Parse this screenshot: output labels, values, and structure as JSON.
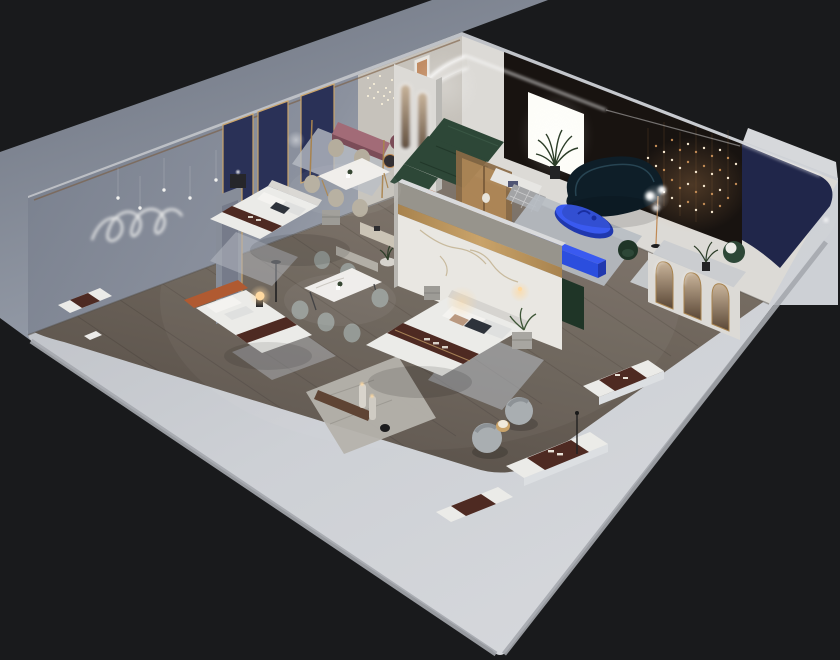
{
  "meta": {
    "label": "Isometric 3D cutaway render of a furnished apartment showroom with bedrooms, dining sets, lounge and living area"
  },
  "palette": {
    "bg": "#191a1c",
    "backdropLight": "#9ba2ae",
    "backdropDark": "#6e7481",
    "slabTop": "#cdd0d5",
    "slabTopDark": "#b4b7bd",
    "slabSide": "#a6a9af",
    "wallTop": "#d6d8db",
    "wallFace": "#8b919e",
    "wallFaceDark": "#767d8b",
    "wallWarm": "#c6c2bb",
    "wallWhite": "#dcdad6",
    "woodLight": "#7d7368",
    "woodDark": "#564e47",
    "marble": "#e9e7e2",
    "marbleVein": "#c2b291",
    "marbleGray": "#97948c",
    "gold": "#a8834e",
    "goldBright": "#c9a36a",
    "navy": "#2a3157",
    "navyCanopy": "#20264a",
    "darkWall": "#181310",
    "lightPanel": "#fdfdf8",
    "greenSofa": "#2d4737",
    "greenDark": "#1f3527",
    "teal": "#0e1e28",
    "tealEdge": "#2e4d5c",
    "cobalt": "#2b4ede",
    "cobaltLight": "#3a5af0",
    "cobaltDark": "#2038ae",
    "rose": "#a26b77",
    "mauve": "#7b4c58",
    "rust": "#b05a31",
    "brandBrown": "#4e2a22",
    "bedWhite": "#ebebe8",
    "pillowShade": "#dfe0df",
    "pillowDark": "#2e333b",
    "rugLight": "#b7bcc3",
    "rugPale": "#c9ccd0",
    "teddy": "#a9aeb1",
    "teddyShade": "#8d9296",
    "copper": "#c08a55",
    "copperWire": "#8a6038",
    "warmGlow": "#ffd9a0",
    "plant": "#3e5637",
    "plantDark": "#2c3d28",
    "silver": "#dcdfe2",
    "charcoal": "#26262a",
    "benchWood": "#5f4434",
    "marbleStrip": "#b5b2ac",
    "creamChair": "#b5ad9d",
    "grayChair": "#959a96",
    "white": "#ffffff"
  },
  "scene": {
    "type": "isometric-cutaway-interior",
    "areas": [
      {
        "name": "left-wall",
        "features": [
          "neon-squiggle-light",
          "hanging-pendant-dots",
          "navy-gold-panels",
          "framed-art"
        ]
      },
      {
        "name": "right-wall",
        "features": [
          "led-arch-corner",
          "backlit-light-panel",
          "dark-feature-wall",
          "copper-fairy-lights",
          "navy-curved-canopy"
        ]
      },
      {
        "name": "living-room",
        "objects": [
          "green-sectional-sofa",
          "wood-glass-partition",
          "teal-curved-sofa",
          "cobalt-oval-table",
          "cobalt-tv-console",
          "globe-floor-lamp",
          "green-accent-chair",
          "palm-plant",
          "checkered-ottoman",
          "white-credenza"
        ]
      },
      {
        "name": "lounge",
        "objects": [
          "rose-bench",
          "mauve-poufs",
          "round-tray-table",
          "rust-armchairs",
          "cluster-pendant",
          "pill-arch-partition"
        ]
      },
      {
        "name": "dining",
        "objects": [
          "dining-table-a",
          "cream-chairs",
          "dining-table-b",
          "gray-chairs",
          "black-floor-lamp",
          "brass-poles"
        ]
      },
      {
        "name": "bedrooms",
        "objects": [
          "bed-a",
          "bed-b-orange-headboard",
          "bed-c-marble-partition",
          "nightstands",
          "glowing-orb-lamp",
          "brand-runner-throws"
        ]
      },
      {
        "name": "showroom-margin",
        "objects": [
          "mattress-display-1",
          "mattress-display-2",
          "mattress-display-3",
          "mattress-display-4",
          "teddy-swivel-chairs",
          "gold-side-table",
          "arched-gold-mirrors",
          "marble-walkway",
          "cylinder-lamps",
          "pole-lamp"
        ]
      }
    ],
    "bed_count": 4,
    "mattress_display_count": 4,
    "dining_set_count": 2
  }
}
